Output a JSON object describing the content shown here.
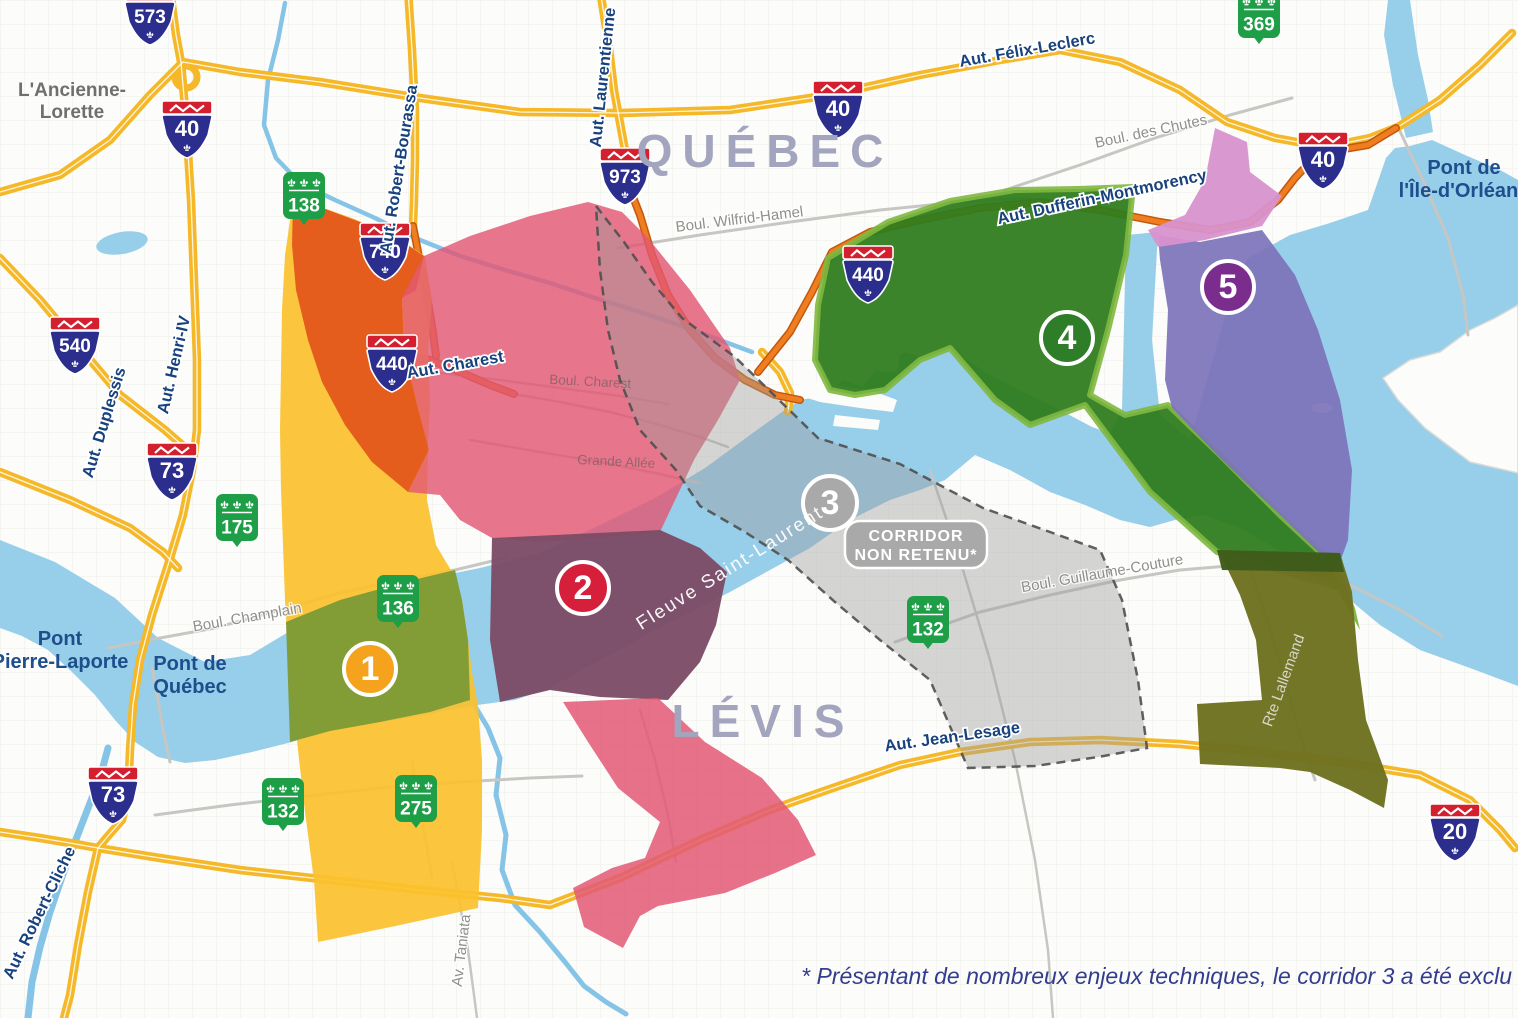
{
  "colors": {
    "land": "#FCFCFA",
    "grid": "#E9E9E4",
    "water": "#97CEEA",
    "river": "#85C4E6",
    "road_yellow": "#F5B829",
    "road_yellow_center": "#FFFFFF",
    "road_orange": "#F07D1F",
    "road_orange_casing": "#C1580E",
    "road_gray": "#C6C6C3",
    "dash": "#4F4F4F",
    "shield_blue": "#2B2E8C",
    "shield_red": "#D31F2E",
    "shield_green": "#1E9E47",
    "city_label": "#A3A4BE",
    "town_label": "#6F6F6F",
    "bridge_label": "#1F4E8C",
    "navy_label": "#17427E",
    "gray_label": "#8F8F8C",
    "light_label": "#D8D8CC",
    "water_label": "#FFFFFF",
    "footnote": "#333D8F"
  },
  "corridors": {
    "c1": {
      "number": "1",
      "fill": "#FBC12E",
      "marker_fill": "#F5A31C",
      "marker": {
        "x": 370,
        "y": 669
      }
    },
    "c2": {
      "number": "2",
      "fill": "#E25874",
      "marker_fill": "#D6203B",
      "marker": {
        "x": 583,
        "y": 588
      }
    },
    "c3": {
      "number": "3",
      "fill": "#9E9E9E",
      "marker_fill": "#A9A9A9",
      "marker": {
        "x": 830,
        "y": 503
      },
      "badge": {
        "line1": "CORRIDOR",
        "line2": "NON RETENU*"
      }
    },
    "c4": {
      "number": "4",
      "fill": "#2F7C1E",
      "edge": "#7EB83F",
      "marker_fill": "#2E7D28",
      "marker": {
        "x": 1067,
        "y": 338
      }
    },
    "c5": {
      "number": "5",
      "fill": "#7C73B8",
      "marker_fill": "#7B2D8E",
      "marker": {
        "x": 1228,
        "y": 287
      }
    },
    "overlaps": {
      "c1c2": "#E4571B",
      "c1water": "#7E9B36",
      "c2water": "#7C4C66",
      "c4c5": "#6E7120",
      "c4c5dark": "#3F5C1B",
      "c5magenta": "#D892CE",
      "sliver": "#7EB83F"
    }
  },
  "shields": {
    "autoroute": [
      {
        "num": "573",
        "x": 150,
        "y": 15
      },
      {
        "num": "40",
        "x": 187,
        "y": 128
      },
      {
        "num": "40",
        "x": 838,
        "y": 108
      },
      {
        "num": "40",
        "x": 1323,
        "y": 159
      },
      {
        "num": "540",
        "x": 75,
        "y": 344
      },
      {
        "num": "73",
        "x": 172,
        "y": 470
      },
      {
        "num": "73",
        "x": 113,
        "y": 794
      },
      {
        "num": "740",
        "x": 385,
        "y": 250
      },
      {
        "num": "973",
        "x": 625,
        "y": 175
      },
      {
        "num": "440",
        "x": 392,
        "y": 362
      },
      {
        "num": "440",
        "x": 868,
        "y": 273
      },
      {
        "num": "20",
        "x": 1455,
        "y": 831
      }
    ],
    "route": [
      {
        "num": "138",
        "x": 304,
        "y": 199
      },
      {
        "num": "175",
        "x": 237,
        "y": 521
      },
      {
        "num": "136",
        "x": 398,
        "y": 602
      },
      {
        "num": "132",
        "x": 283,
        "y": 805
      },
      {
        "num": "275",
        "x": 416,
        "y": 802
      },
      {
        "num": "132",
        "x": 928,
        "y": 623
      },
      {
        "num": "369",
        "x": 1259,
        "y": 18
      }
    ]
  },
  "labels": {
    "cities": [
      {
        "text": "QUÉBEC",
        "x": 765,
        "y": 167
      },
      {
        "text": "LÉVIS",
        "x": 763,
        "y": 737
      }
    ],
    "town": {
      "lines": [
        "L'Ancienne-",
        "Lorette"
      ],
      "x": 72,
      "y": 96
    },
    "bridges": [
      {
        "lines": [
          "Pont",
          "Pierre-Laporte"
        ],
        "x": 60,
        "y": 645
      },
      {
        "lines": [
          "Pont de",
          "Québec"
        ],
        "x": 190,
        "y": 670
      },
      {
        "lines": [
          "Pont de",
          "l'Île-d'Orléans"
        ],
        "x": 1464,
        "y": 174
      }
    ],
    "roads_navy": [
      {
        "text": "Aut. Félix-Leclerc",
        "x": 1028,
        "y": 55,
        "rot": -10
      },
      {
        "text": "Aut. Jean-Lesage",
        "x": 953,
        "y": 742,
        "rot": -8
      },
      {
        "text": "Aut. Dufferin-Montmorency",
        "x": 1103,
        "y": 202,
        "rot": -12
      },
      {
        "text": "Aut. Charest",
        "x": 456,
        "y": 370,
        "rot": -10
      },
      {
        "text": "Aut. Robert-Bourassa",
        "x": 404,
        "y": 170,
        "rot": -81
      },
      {
        "text": "Aut. Laurentienne",
        "x": 608,
        "y": 78,
        "rot": -84
      },
      {
        "text": "Aut. Henri-IV",
        "x": 179,
        "y": 366,
        "rot": -77
      },
      {
        "text": "Aut. Duplessis",
        "x": 109,
        "y": 424,
        "rot": -73
      },
      {
        "text": "Aut. Robert-Cliche",
        "x": 44,
        "y": 915,
        "rot": -64
      }
    ],
    "roads_gray": [
      {
        "text": "Boul. Wilfrid-Hamel",
        "x": 740,
        "y": 224,
        "rot": -7
      },
      {
        "text": "Boul. des Chutes",
        "x": 1152,
        "y": 136,
        "rot": -12
      },
      {
        "text": "Boul. Champlain",
        "x": 248,
        "y": 622,
        "rot": -10
      },
      {
        "text": "Boul. Guillaume-Couture",
        "x": 1103,
        "y": 578,
        "rot": -10
      },
      {
        "text": "Av. Taniata",
        "x": 466,
        "y": 951,
        "rot": -83
      },
      {
        "text": "Rte Lallemand",
        "x": 1288,
        "y": 682,
        "rot": -70,
        "light": true
      }
    ],
    "faint": [
      {
        "text": "Boul. Charest",
        "x": 590,
        "y": 386,
        "rot": 3
      },
      {
        "text": "Grande Allée",
        "x": 616,
        "y": 466,
        "rot": 3
      }
    ],
    "water": {
      "text": "Fleuve Saint-Laurent",
      "x": 733,
      "y": 573,
      "rot": -32
    }
  },
  "footnote": {
    "text": "* Présentant de nombreux enjeux techniques, le corridor 3 a été exclu"
  }
}
